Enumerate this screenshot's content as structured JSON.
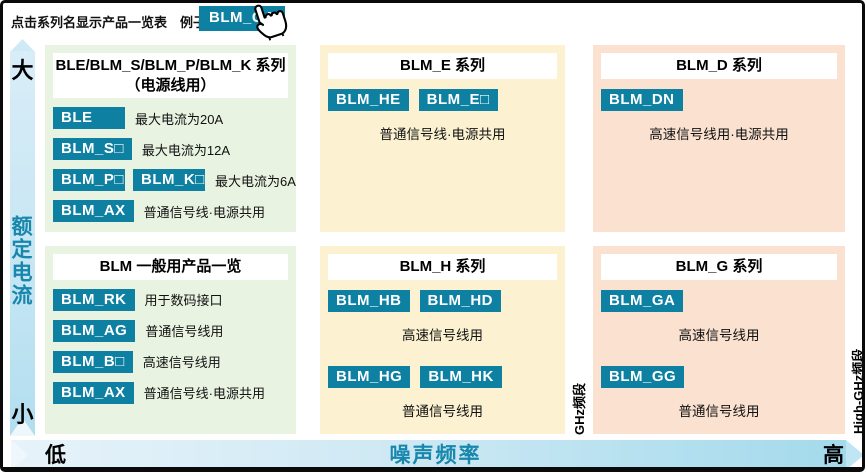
{
  "colors": {
    "button_bg": "#0e81a2",
    "panel_green": "#e8f3e1",
    "panel_yellow": "#fcf2d2",
    "panel_salmon": "#fae1d0",
    "axis_text": "#1787ad"
  },
  "instruction": {
    "label": "点击系列名显示产品一览表　例子）",
    "example_button_label": "BLM_GA"
  },
  "axes": {
    "y_axis": {
      "top": "大",
      "label": "额定电流",
      "bottom": "小"
    },
    "x_axis": {
      "left": "低",
      "label": "噪声频率",
      "right": "高"
    },
    "bands": {
      "mid": "GHz频段",
      "right": "High-GHz频段"
    }
  },
  "panels": [
    {
      "id": "power-line-series",
      "type": "list",
      "color": "green",
      "title_lines": [
        "BLE/BLM_S/BLM_P/BLM_K 系列",
        "（电源线用）"
      ],
      "rows": [
        {
          "buttons": [
            "BLE"
          ],
          "label": "最大电流为20A"
        },
        {
          "buttons": [
            "BLM_S□"
          ],
          "label": "最大电流为12A"
        },
        {
          "buttons": [
            "BLM_P□",
            "BLM_K□"
          ],
          "label": "最大电流为6A"
        },
        {
          "buttons": [
            "BLM_AX"
          ],
          "label": "普通信号线·电源共用"
        }
      ]
    },
    {
      "id": "blm-e-series",
      "type": "center",
      "color": "yellow",
      "title_lines": [
        "BLM_E 系列"
      ],
      "groups": [
        {
          "buttons": [
            "BLM_HE",
            "BLM_E□"
          ],
          "caption": "普通信号线·电源共用"
        }
      ]
    },
    {
      "id": "blm-d-series",
      "type": "center",
      "color": "salmon",
      "title_lines": [
        "BLM_D 系列"
      ],
      "groups": [
        {
          "buttons": [
            "BLM_DN"
          ],
          "caption": "高速信号线用·电源共用"
        }
      ]
    },
    {
      "id": "blm-general-series",
      "type": "list",
      "color": "green",
      "title_lines": [
        "BLM 一般用产品一览"
      ],
      "rows": [
        {
          "buttons": [
            "BLM_RK"
          ],
          "label": "用于数码接口"
        },
        {
          "buttons": [
            "BLM_AG"
          ],
          "label": "普通信号线用"
        },
        {
          "buttons": [
            "BLM_B□"
          ],
          "label": "高速信号线用"
        },
        {
          "buttons": [
            "BLM_AX"
          ],
          "label": "普通信号线·电源共用"
        }
      ]
    },
    {
      "id": "blm-h-series",
      "type": "center",
      "color": "yellow",
      "title_lines": [
        "BLM_H 系列"
      ],
      "groups": [
        {
          "buttons": [
            "BLM_HB",
            "BLM_HD"
          ],
          "caption": "高速信号线用"
        },
        {
          "buttons": [
            "BLM_HG",
            "BLM_HK"
          ],
          "caption": "普通信号线用"
        }
      ]
    },
    {
      "id": "blm-g-series",
      "type": "center",
      "color": "salmon",
      "title_lines": [
        "BLM_G 系列"
      ],
      "groups": [
        {
          "buttons": [
            "BLM_GA"
          ],
          "caption": "高速信号线用"
        },
        {
          "buttons": [
            "BLM_GG"
          ],
          "caption": "普通信号线用"
        }
      ]
    }
  ]
}
